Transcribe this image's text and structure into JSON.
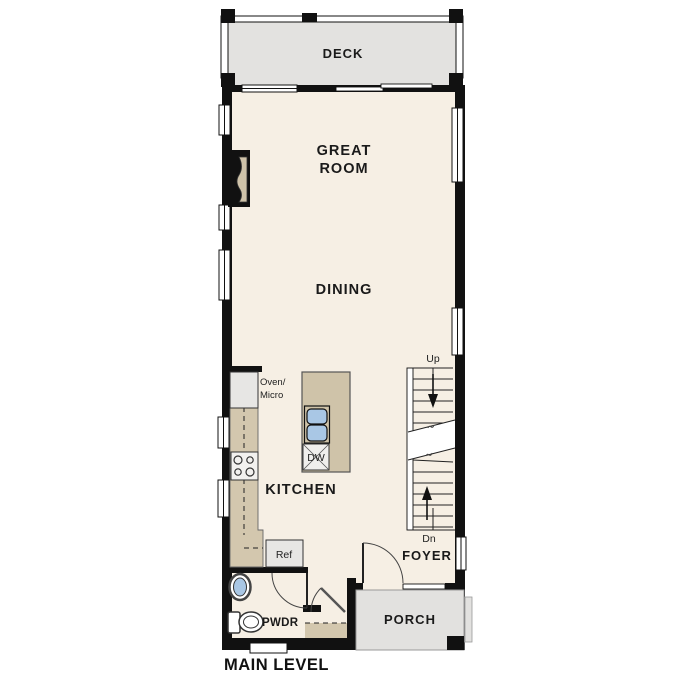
{
  "title": "MAIN LEVEL",
  "palette": {
    "wall": "#111111",
    "floor": "#f6efe4",
    "deck": "#e3e2e0",
    "porch": "#e2e1df",
    "counter": "#d3c7ae",
    "island": "#cfc3a9",
    "appliance": "#e7e6e4",
    "fireplace_niche": "#cfc3a9",
    "sink_blue": "#a9c7e5",
    "text": "#1a1a1a"
  },
  "rooms": {
    "deck": {
      "label": "DECK"
    },
    "great_room": {
      "line1": "GREAT",
      "line2": "ROOM"
    },
    "dining": {
      "label": "DINING"
    },
    "kitchen": {
      "label": "KITCHEN"
    },
    "foyer": {
      "label": "FOYER"
    },
    "porch": {
      "label": "PORCH"
    },
    "powder": {
      "label": "PWDR"
    }
  },
  "fixtures": {
    "oven_micro": {
      "line1": "Oven/",
      "line2": "Micro"
    },
    "dishwasher": {
      "label": "DW"
    },
    "refrigerator": {
      "label": "Ref"
    }
  },
  "stairs": {
    "up_label": "Up",
    "down_label": "Dn"
  }
}
